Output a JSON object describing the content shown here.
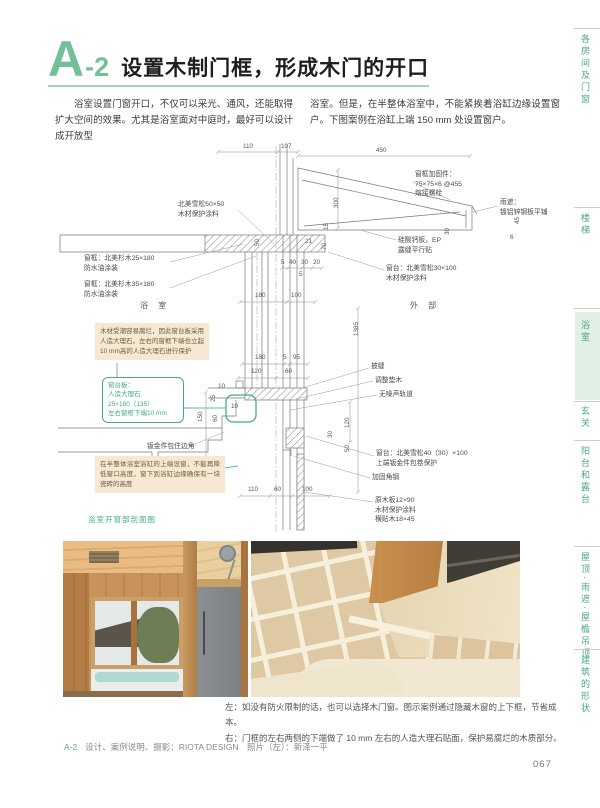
{
  "accent": {
    "green": "#4fae85",
    "light_green_bg": "#e2efe6",
    "tan_note_bg": "#f6e8d2",
    "teal_leader": "#55bca6"
  },
  "header": {
    "badge_letter": "A",
    "badge_num": "-2",
    "title": "设置木制门框，形成木门的开口"
  },
  "intro": {
    "col_left": "浴室设置门窗开口，不仅可以采光、通风，还能取得扩大空间的效果。尤其是浴室面对中庭时，最好可以设计成开放型",
    "col_right": "浴室。但是，在半整体浴室中，不能紧挨着浴缸边缘设置窗户。下图案例在浴缸上端 150 mm 处设置窗户。"
  },
  "drawing": {
    "caption": "浴室开窗部剖面图",
    "rooms": {
      "bath": "浴 室",
      "exterior": "外 部"
    },
    "labels": {
      "cedar50_1": "北美雪松50×50",
      "cedar50_2": "木材保护涂料",
      "frame25_1": "窗框：北美杉木25×180",
      "frame25_2": "防水油涂装",
      "frame35_1": "窗框：北美杉木35×180",
      "frame35_2": "防水油涂装",
      "reinforce_1": "窗框加固件：",
      "reinforce_2": "75×75×6 @455",
      "reinforce_3": "熔接螺栓",
      "rain_1": "雨遮：",
      "rain_2": "镀铝锌钢板平铺",
      "board_1": "硅酸钙板，EP",
      "board_2": "露缝平行贴",
      "sill30_1": "窗台：北美雪松30×100",
      "sill30_2": "木材保护涂料",
      "hifuki": "披缝",
      "pad": "调整垫木",
      "rail": "无噪声轨道",
      "sheet": "钣金件包住边角",
      "sill40_1": "窗台：北美雪松40（30）×100",
      "sill40_2": "上端钣金件包卷保护",
      "angle": "加固角钢",
      "wood12_1": "原木板12×90",
      "wood12_2": "木材保护涂料",
      "wood12_3": "横贴木18×45"
    },
    "notes": {
      "moisture": "木材受潮容易腐烂，因此窗台板采用人造大理石，左右的窗框下端也立起10 mm高的人造大理石进行保护",
      "sill_1": "窗台板：",
      "sill_2": "人造大理石",
      "sill_3": "25×180（135）",
      "sill_4": "左右窗框下端10 mm",
      "tub": "在半整体浴室浴缸的上端设窗，不能再降低窗口高度，窗下到浴缸边缘确保有一块瓷砖的高度"
    },
    "dims": {
      "d_110": "110",
      "d_107": "107",
      "d_450": "450",
      "d_300": "300",
      "d_45": "45",
      "d_30a": "30",
      "d_6": "6",
      "d_15": "15",
      "d_70": "70",
      "d_21": "21",
      "d_50": "50",
      "d_5a": "5",
      "d_40": "40",
      "d_30b": "30",
      "d_20": "20",
      "d_5b": "5",
      "d_180a": "180",
      "d_100a": "100",
      "d_1385": "1385",
      "d_180b": "180",
      "d_5c": "5",
      "d_95": "95",
      "d_120a": "120",
      "d_60a": "60",
      "d_10a": "10",
      "d_25": "25",
      "d_60b": "60",
      "d_150": "150",
      "d_10g": "10",
      "d_120b": "120",
      "d_30c": "30",
      "d_50b": "50",
      "d_110b": "110",
      "d_60c": "60",
      "d_100b": "100"
    }
  },
  "photos": {
    "caption_line1": "左：如没有防火限制的话，也可以选择木门窗。图示案例通过隐藏木窗的上下框，节省成本。",
    "caption_line2": "右：门框的左右两侧的下端做了 10 mm 左右的人造大理石贴面，保护易腐烂的木质部分。",
    "credit_prefix": "A-2",
    "credit": "设计、案例说明、摄影：RIOTA DESIGN　照片（左）：新泽一平"
  },
  "sidebar": {
    "tabs": [
      "各房间及门窗",
      "楼梯",
      "浴室",
      "玄关",
      "阳台和露台",
      "屋顶·雨遮·屋檐吊顶",
      "建筑的形状"
    ],
    "active": "浴室"
  },
  "page": {
    "number": "067"
  }
}
